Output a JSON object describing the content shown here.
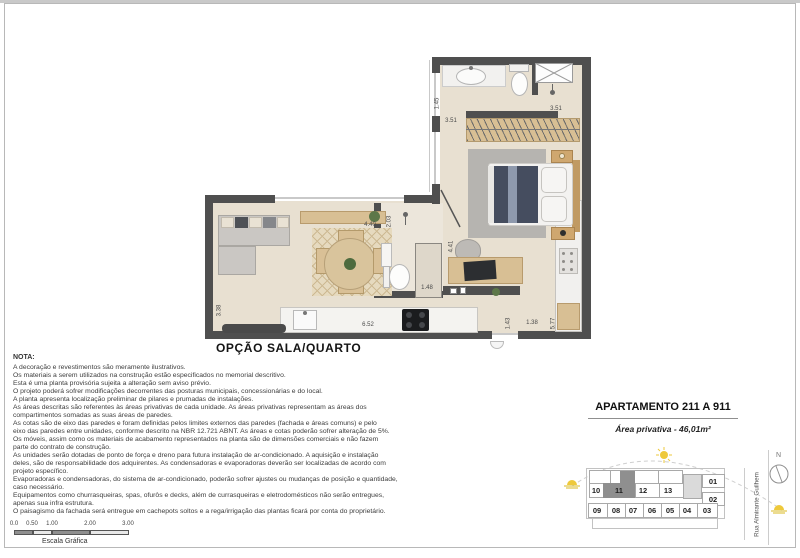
{
  "plan": {
    "label": "OPÇÃO SALA/QUARTO",
    "dims": {
      "a": "1.45",
      "b": "3.51",
      "c": "3.51",
      "d": "4.40",
      "e": "2.03",
      "f": "4.41",
      "g": "1.48",
      "h": "3.38",
      "i": "6.52",
      "j": "1.43",
      "k": "1.38",
      "l": "5.77"
    }
  },
  "nota": {
    "heading": "NOTA:",
    "lines": [
      "A decoração e revestimentos são meramente ilustrativos.",
      "Os materiais a serem utilizados na construção estão especificados no memorial descritivo.",
      "Esta é uma planta provisória sujeita a alteração sem aviso prévio.",
      "O projeto poderá sofrer modificações decorrentes das posturas municipais, concessionárias e do local.",
      "A planta apresenta localização preliminar de pilares e prumadas de instalações.",
      "As áreas descritas são referentes às áreas privativas de cada unidade. As áreas privativas representam as áreas dos",
      "compartimentos somadas as suas áreas de paredes.",
      "As cotas são de eixo das paredes e foram definidas pelos limites externos das paredes (fachada e áreas comuns) e pelo",
      "eixo das paredes entre unidades, conforme descrito na NBR 12.721 ABNT. As áreas e cotas poderão sofrer alteração de 5%.",
      "Os móveis, assim como os materiais de acabamento representados na planta são de dimensões comerciais e não fazem",
      "parte do contrato de construção.",
      "As unidades serão dotadas de ponto de força e dreno para futura instalação de ar-condicionado. A aquisição e instalação",
      "deles, são de responsabilidade dos adquirentes. As condensadoras e evaporadoras deverão ser localizadas de acordo com",
      "projeto específico.",
      "Evaporadoras e condensadoras, do sistema de ar-condicionado, poderão sofrer ajustes ou mudanças de posição e quantidade,",
      "caso necessário.",
      "Equipamentos como churrasqueiras, spas, ofurôs e decks, além de currasqueiras e eletrodomésticos não serão entregues,",
      "apenas sua infra estrutura.",
      "O paisagismo da fachada será entregue em cachepots soltos e a rega/irrigação das plantas ficará por conta do proprietário."
    ]
  },
  "scale": {
    "ticks": [
      "0.0",
      "0.50",
      "1.00",
      "2.00",
      "3.00"
    ],
    "caption": "Escala Gráfica"
  },
  "panel": {
    "title": "APARTAMENTO 211 A 911",
    "area": "Área privativa - 46,01m²"
  },
  "keyplan": {
    "units_top": [
      "10",
      "11",
      "12",
      "13"
    ],
    "units_right": [
      "01",
      "02"
    ],
    "units_bottom": [
      "09",
      "08",
      "07",
      "06",
      "05",
      "04",
      "03"
    ],
    "highlighted_unit": "11",
    "street": "Rua Almirante Guilhem",
    "north": "N"
  },
  "colors": {
    "wall": "#4f4f4f",
    "floor": "#e8e0d1",
    "floorBath": "#ece6db",
    "wood": "#d8bf94",
    "rug": "#b6b4b0",
    "duvet": "#454d5f",
    "highlight": "#8f8f8f",
    "sun": "#eec93c",
    "lineLight": "#c9c9c9"
  }
}
